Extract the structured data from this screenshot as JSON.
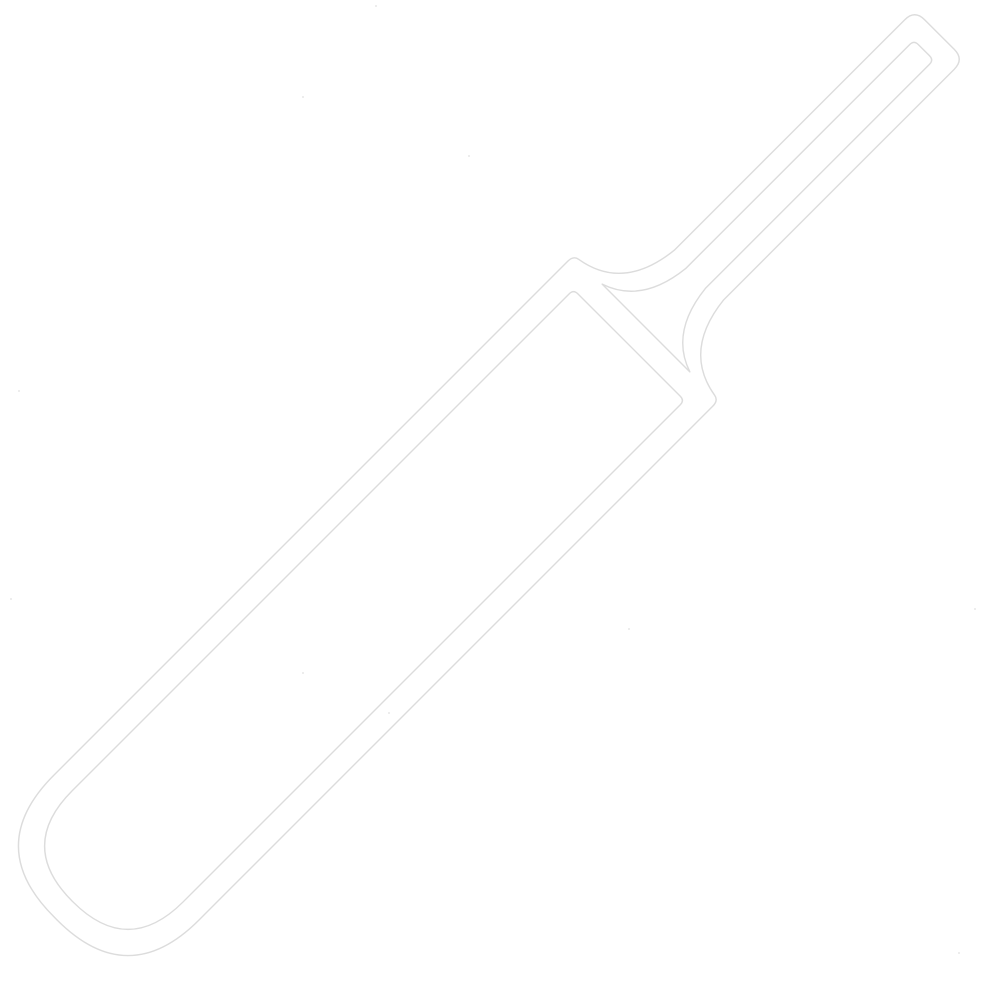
{
  "page": {
    "background_color": "#ffffff",
    "width": 1008,
    "height": 987
  },
  "icon": {
    "name": "cricket-bat",
    "description": "Faint white outline icon of a cricket bat, rotated 45 degrees with the handle pointing to the top-right corner and the rounded blade toe at the bottom-left",
    "viewbox": "0 0 1008 987",
    "fill_color": "#ffffff",
    "outline_color": "#dcdcdc",
    "outline_width": "1.4",
    "placement_transform": "translate(646,328) rotate(45)",
    "path": "M -35 -401 L -35 -75 Q -42 -10 -96 -1 Q -102.5 0 -102.5 8 L -102.5 735 Q -102.5 835 -2.5 835 L 2.5 835 Q 102.5 835 102.5 735 L 102.5 8 Q 102.5 0 96 -1 Q 42 -10 35 -75 L 35 -401 Q 35 -415 21 -415 L -21 -415 Q -35 -415 -35 -401 Z M -62 0 L 62 0 Q 20 -14 14 -70 L 14 -387 Q 14 -393 8 -393 L -8 -393 Q -14 -393 -14 -387 L -14 -70 Q -20 -14 -62 0 Z M -72.5 24 L 72.5 24 Q 78.5 24 78.5 30 L 78.5 733 Q 78.5 811 0.5 811 L -0.5 811 Q -78.5 811 -78.5 733 L -78.5 30 Q -78.5 24 -72.5 24 Z"
  },
  "artifacts": {
    "dot_color": "#c9c9c9",
    "dots": [
      {
        "x": 375,
        "y": 5
      },
      {
        "x": 302,
        "y": 96
      },
      {
        "x": 468,
        "y": 155
      },
      {
        "x": 18,
        "y": 390
      },
      {
        "x": 10,
        "y": 598
      },
      {
        "x": 974,
        "y": 608
      },
      {
        "x": 628,
        "y": 628
      },
      {
        "x": 302,
        "y": 672
      },
      {
        "x": 388,
        "y": 712
      },
      {
        "x": 958,
        "y": 952
      }
    ]
  }
}
